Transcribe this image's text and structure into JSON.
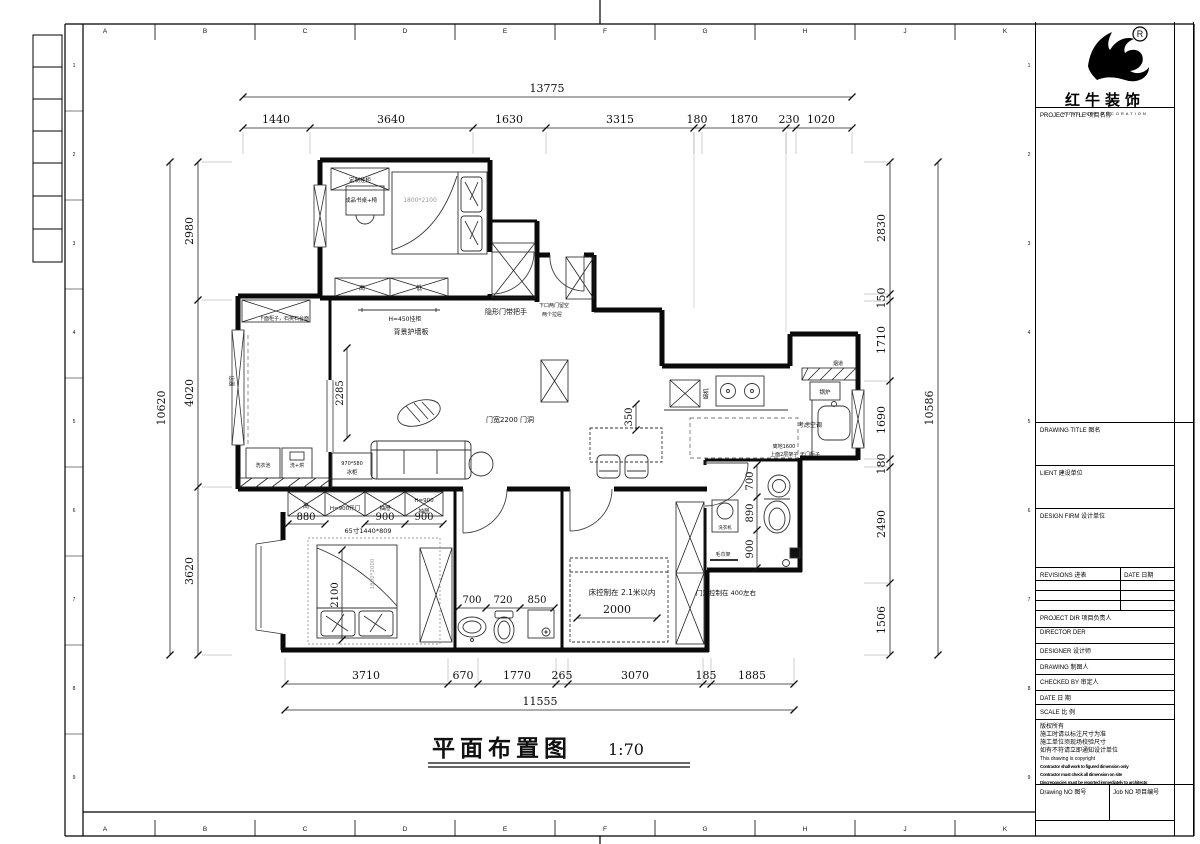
{
  "sheet": {
    "grid_letters": [
      "A",
      "B",
      "C",
      "D",
      "E",
      "F",
      "G",
      "H",
      "J",
      "K"
    ],
    "row_numbers": [
      "1",
      "2",
      "3",
      "4",
      "5",
      "6",
      "7",
      "8",
      "9"
    ]
  },
  "title_block": {
    "brand": {
      "registered": "®",
      "name_cn": "红牛装饰",
      "name_en": "HONG NIU DECORATION"
    },
    "rows": {
      "project_title": "PROJECT TITLE  项目名称",
      "drawing_title": "DRAWING TITLE  图名",
      "client": "LIENT  建设单位",
      "design_firm": "DESIGN FIRM  设计单位",
      "revisions": "REVISIONS  进表",
      "rev_date": "DATE  日期",
      "project_dir": "PROJECT DIR   项目负责人",
      "director": "DIRECTOR DER",
      "designer": "DESIGNER      设计师",
      "drawing": "DRAWING       制图人",
      "checked_by": "CHECKED BY  审定人",
      "date": "DATE            日  期",
      "scale": "SCALE           比  例",
      "drawing_no": "Drawing NO  图号",
      "job_no": "Job NO  项目编号"
    },
    "notes": [
      "版权所有",
      "施工时请以标注尺寸为准",
      "施工单位须现场校验尺寸",
      "如有不符请立即通知设计单位",
      "This drawing is copyright",
      "Contractor shall work to figured dimension only",
      "Contractor must check all dimension on site",
      "Discrepancies must be reported immediately to architects"
    ]
  },
  "plan": {
    "title": "平面布置图",
    "scale": "1:70",
    "dims": {
      "top": {
        "total": "13775",
        "segments": [
          "1440",
          "3640",
          "1630",
          "3315",
          "180",
          "1870",
          "230",
          "1020"
        ]
      },
      "bottom": {
        "total": "11555",
        "segments": [
          "3710",
          "670",
          "1770",
          "265",
          "3070",
          "185",
          "1885"
        ]
      },
      "left": {
        "total": "10620",
        "segments": [
          "2980",
          "4020",
          "3620"
        ]
      },
      "right": {
        "total": "10586",
        "segments": [
          "2830",
          "150",
          "1710",
          "1690",
          "180",
          "2490",
          "1506"
        ]
      }
    },
    "labels": {
      "cabinet_custom": "定制挂柜",
      "desk": "成品书桌+椅",
      "bed1_size": "1800*2100",
      "cab_high": "高",
      "cab_low": "低",
      "shelf": "H=450挂柜",
      "wall_panel": "背景护墙板",
      "hidden_door": "隐形门带把手",
      "cab_note1": "下口两门留空",
      "cab_note2": "两个拉屉",
      "door_2200": "门宽2200 门洞",
      "fridge_size": "970*580",
      "fridge": "冰柜",
      "counter_note": "下面柜子，石英石台面",
      "curtain": "窗帘",
      "laundry_sink": "洗衣池",
      "washer_dryer": "洗+烘",
      "hood": "烟机",
      "boiler": "锅炉",
      "flue": "烟道",
      "ac_note": "考虑空调",
      "shelf_note1": "离地1600",
      "shelf_note2": "上面2层架子 无门柜子",
      "tv_high": "高",
      "tv_door": "H=900开门",
      "tv_drawer1": "抽屉",
      "tv_h900": "H=900",
      "tv_drawer2": "抽屉",
      "tv_size": "65寸1440*809",
      "bed3_size": "1800*2000",
      "bed2_note": "床控制在  2.1米以内",
      "door_note": "门洞控制在  400左右",
      "washer": "洗衣机",
      "towel": "毛巾架",
      "d2285": "2285",
      "d2100": "2100",
      "d2000": "2000",
      "d350": "350",
      "b700": "700",
      "b720": "720",
      "b850": "850",
      "t880": "880",
      "t900a": "900",
      "t900b": "900",
      "r700": "700",
      "r890": "890",
      "r900": "900"
    }
  }
}
